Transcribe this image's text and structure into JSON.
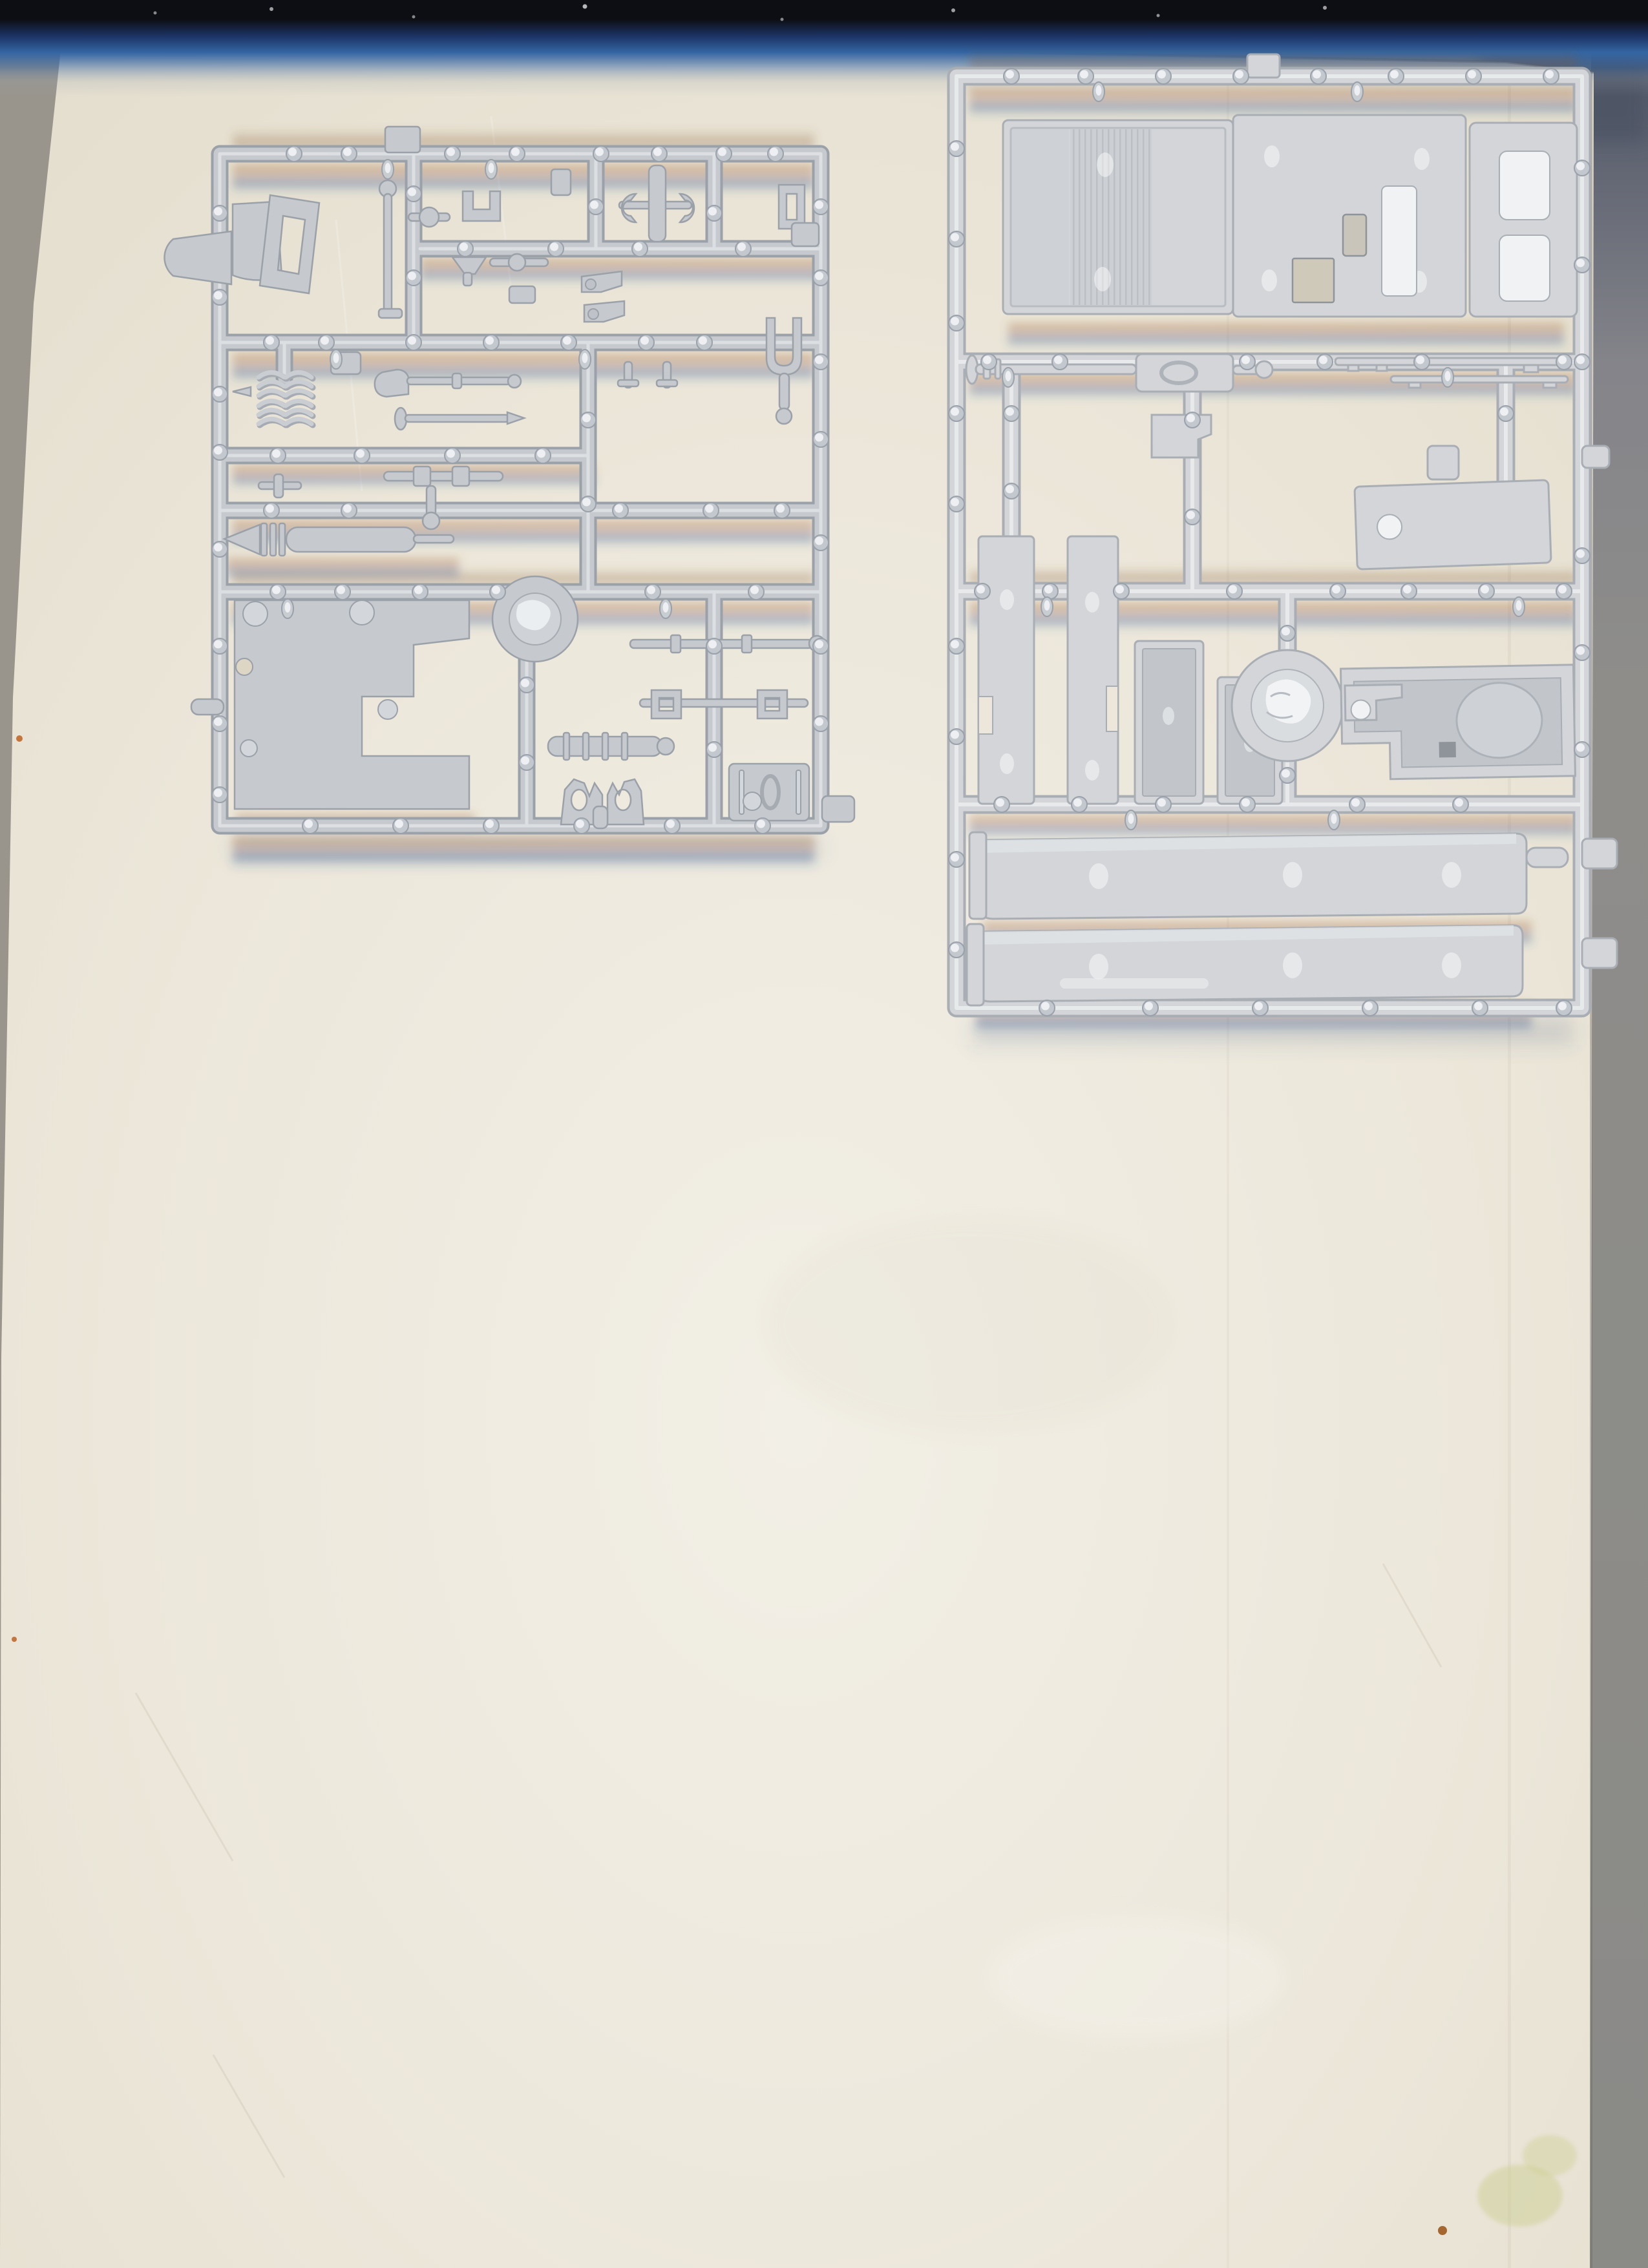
{
  "description": "Flatbed scan of two light-grey polystyrene model-kit sprues full of truck parts lying on a cream sheet of paper. A dark blue-black scanner band runs along the top edge, grey scanner margins show at the left and right edges, orange and blue chromatic-aberration streaks glow around the runners, and a few small stains mark the paper.",
  "objects": {
    "left_sprue": {
      "label": "Dense sprue of small chassis parts: windscreen frame, cowl, gear lever, leaf springs, tie rods, exhaust muffler, mounting plate with cut-out, wheel disc, claw brackets and a seat panel",
      "plastic_color": "#c6c9ce"
    },
    "right_sprue": {
      "label": "Sprue of large truck body parts: cab floor with ribbed deck, roof panel with openings, door panel with pads, drive shaft, side plates, trays, wheel disc, cab interior tub and two long chassis rails",
      "plastic_color": "#d3d5d8"
    }
  },
  "colors": {
    "paper": "#ece7da",
    "paper-deep": "#ddd6c4",
    "paper-bright": "#f2efe6",
    "scanner-grey": "#99958d",
    "corner-dark": "#4c5364",
    "right-strip": "#8e8d8a",
    "band-black": "#0d0e13",
    "band-navy": "#1d3567",
    "band-blue": "#3465a2",
    "plastic-l": "#c6c9ce",
    "plastic-l-dark": "#9ba1a9",
    "plastic-l-lite": "#e9ebee",
    "plastic-r": "#d3d5d8",
    "plastic-r-dark": "#a9aeb5",
    "plastic-r-lite": "#f0f2f4",
    "recess": "#c2c6cb",
    "hole": "#8f949a",
    "streak-orange": "#a4632a",
    "streak-blue": "#2a5796",
    "stain-green": "#c9cc8a",
    "stain-brown": "#a5672f",
    "stain-orange": "#c4763d"
  },
  "artifacts": {
    "top_band": {
      "label": "dark scanner edge band fading through navy and blue into the paper",
      "colors": [
        "#0d0e13",
        "#1d3567",
        "#3465a2"
      ]
    },
    "chromatic_streaks": {
      "label": "orange/blue chromatic aberration streaks around runners",
      "colors": [
        "#a4632a",
        "#2a5796"
      ]
    },
    "stains": [
      {
        "label": "yellow-green smudge near bottom right",
        "color": "#c9cc8a"
      },
      {
        "label": "small brown fleck near bottom right",
        "color": "#a5672f"
      },
      {
        "label": "tiny orange flecks on left margin",
        "color": "#c4763d"
      }
    ]
  }
}
